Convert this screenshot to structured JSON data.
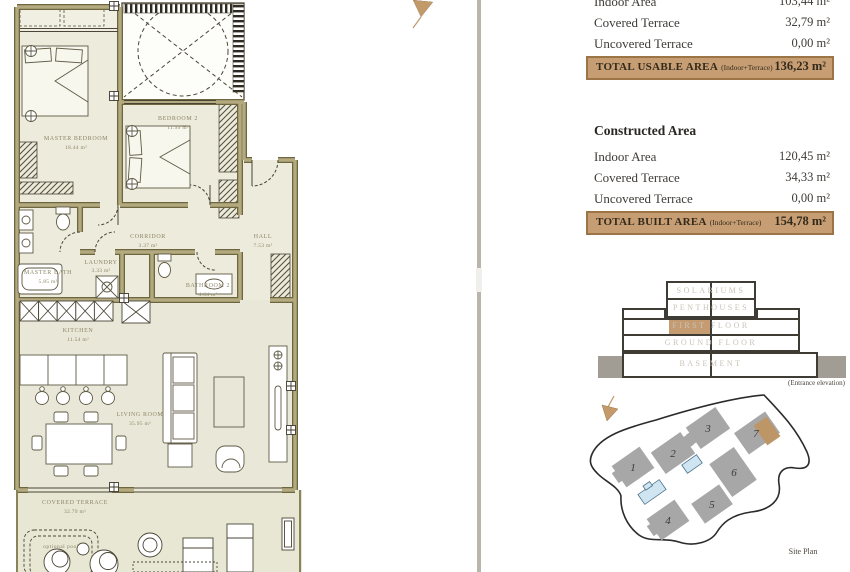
{
  "panel": {
    "usable": {
      "rows": [
        {
          "label": "Indoor Area",
          "value": "103,44 m²"
        },
        {
          "label": "Covered Terrace",
          "value": "32,79 m²"
        },
        {
          "label": "Uncovered Terrace",
          "value": "0,00 m²"
        }
      ],
      "total_label": "TOTAL USABLE AREA",
      "total_note": "(Indoor+Terrace)",
      "total_value": "136,23 m²"
    },
    "constructed": {
      "heading": "Constructed Area",
      "rows": [
        {
          "label": "Indoor Area",
          "value": "120,45 m²"
        },
        {
          "label": "Covered Terrace",
          "value": "34,33 m²"
        },
        {
          "label": "Uncovered Terrace",
          "value": "0,00 m²"
        }
      ],
      "total_label": "TOTAL BUILT AREA",
      "total_note": "(Indoor+Terrace)",
      "total_value": "154,78 m²"
    }
  },
  "elevation": {
    "floors": [
      "SOLARIUMS",
      "PENTHOUSES",
      "FIRST FLOOR",
      "GROUND FLOOR",
      "BASEMENT"
    ],
    "highlighted_floor": "FIRST FLOOR",
    "caption": "(Entrance elevation)"
  },
  "site": {
    "caption": "Site Plan",
    "buildings": [
      "1",
      "2",
      "3",
      "4",
      "5",
      "6",
      "7"
    ],
    "highlighted_building": "7"
  },
  "plan": {
    "rooms": [
      {
        "name": "MASTER BEDROOM",
        "area": "18.44 m²"
      },
      {
        "name": "BEDROOM 2",
        "area": "11.99 m²"
      },
      {
        "name": "CORRIDOR",
        "area": "3.37 m²"
      },
      {
        "name": "HALL",
        "area": "7.53 m²"
      },
      {
        "name": "MASTER BATH",
        "area": "5.85 m²"
      },
      {
        "name": "LAUNDRY",
        "area": "3.33 m²"
      },
      {
        "name": "BATHROOM 2",
        "area": "4.64 m²"
      },
      {
        "name": "KITCHEN",
        "area": "11.54 m²"
      },
      {
        "name": "LIVING ROOM",
        "area": "35.95 m²"
      },
      {
        "name": "COVERED TERRACE",
        "area": "32.79 m²"
      }
    ],
    "pool_label": "optional pool"
  },
  "colors": {
    "accent_tan": "#c79e73",
    "accent_border": "#9c7547",
    "wall_olive": "#9d9366",
    "floor_beige": "#ecebdc",
    "terrace_beige": "#e7e7d4",
    "pool_blue": "#cfe6f2",
    "building_gray": "#a7a7a7"
  }
}
